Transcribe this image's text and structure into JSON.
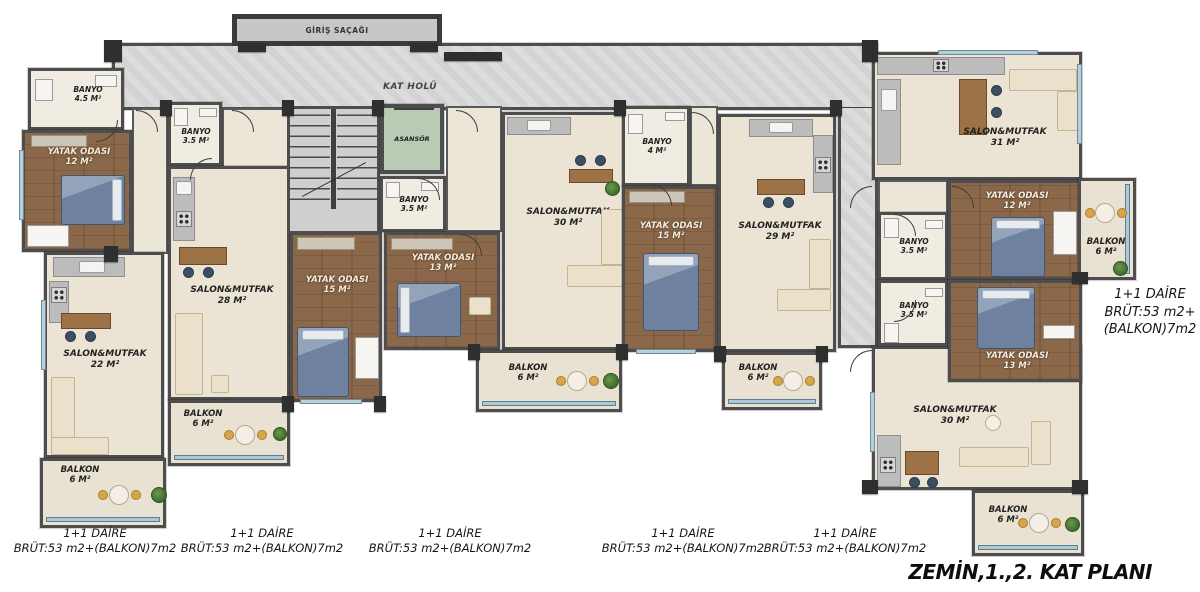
{
  "title": "ZEMİN,1.,2. KAT PLANI",
  "canopy": {
    "label": "GİRİŞ SAÇAĞI"
  },
  "hall": {
    "label": "KAT HOLÜ"
  },
  "elevator": {
    "label": "ASANSÖR"
  },
  "colors": {
    "wall": "#4d4d4d",
    "floor_beige": "#ebe4d4",
    "floor_wood": "#85644a",
    "corridor_tile": "#d3d3d3",
    "elevator_green": "#b9cbb5",
    "balcony_glass": "#aec7d4",
    "bed_blue": "#6e82a0",
    "accent_yellow": "#d7a64b",
    "plant_green": "#4e7d3a"
  },
  "rooms": {
    "apt1_banyo": {
      "label": "BANYO",
      "area": "4.5 M²"
    },
    "apt1_yatak": {
      "label": "YATAK ODASI",
      "area": "12 M²"
    },
    "apt1_salon": {
      "label": "SALON&MUTFAK",
      "area": "22 M²"
    },
    "apt1_balkon": {
      "label": "BALKON",
      "area": "6 M²"
    },
    "apt2_banyo": {
      "label": "BANYO",
      "area": "3.5 M²"
    },
    "apt2_salon": {
      "label": "SALON&MUTFAK",
      "area": "28 M²"
    },
    "apt2_yatak": {
      "label": "YATAK ODASI",
      "area": "15 M²"
    },
    "apt2_balkon": {
      "label": "BALKON",
      "area": "6 M²"
    },
    "apt3_banyo": {
      "label": "BANYO",
      "area": "3.5 M²"
    },
    "apt3_yatak": {
      "label": "YATAK ODASI",
      "area": "13 M²"
    },
    "apt3_salon": {
      "label": "SALON&MUTFAK",
      "area": "30 M²"
    },
    "apt3_balkon": {
      "label": "BALKON",
      "area": "6 M²"
    },
    "apt4_banyo": {
      "label": "BANYO",
      "area": "4 M²"
    },
    "apt4_yatak": {
      "label": "YATAK ODASI",
      "area": "15 M²"
    },
    "apt4_salon": {
      "label": "SALON&MUTFAK",
      "area": "29 M²"
    },
    "apt4_balkon": {
      "label": "BALKON",
      "area": "6 M²"
    },
    "apt6_salon": {
      "label": "SALON&MUTFAK",
      "area": "31 M²"
    },
    "apt6_yatak": {
      "label": "YATAK ODASI",
      "area": "12 M²"
    },
    "apt6_banyo": {
      "label": "BANYO",
      "area": "3.5 M²"
    },
    "apt6_balkon": {
      "label": "BALKON",
      "area": "6 M²"
    },
    "apt7_banyo": {
      "label": "BANYO",
      "area": "3.5 M²"
    },
    "apt7_yatak": {
      "label": "YATAK ODASI",
      "area": "13 M²"
    },
    "apt7_salon": {
      "label": "SALON&MUTFAK",
      "area": "30 M²"
    },
    "apt7_balkon": {
      "label": "BALKON",
      "area": "6 M²"
    }
  },
  "unit_labels": [
    {
      "line1": "1+1 DAİRE",
      "line2": "BRÜT:53 m2+(BALKON)7m2"
    },
    {
      "line1": "1+1 DAİRE",
      "line2": "BRÜT:53 m2+(BALKON)7m2"
    },
    {
      "line1": "1+1 DAİRE",
      "line2": "BRÜT:53 m2+(BALKON)7m2"
    },
    {
      "line1": "1+1 DAİRE",
      "line2": "BRÜT:53 m2+(BALKON)7m2"
    },
    {
      "line1": "1+1 DAİRE",
      "line2": "BRÜT:53 m2+(BALKON)7m2"
    }
  ],
  "side_unit_label": {
    "line1": "1+1 DAİRE",
    "line2": "BRÜT:53 m2+",
    "line3": "(BALKON)7m2"
  }
}
